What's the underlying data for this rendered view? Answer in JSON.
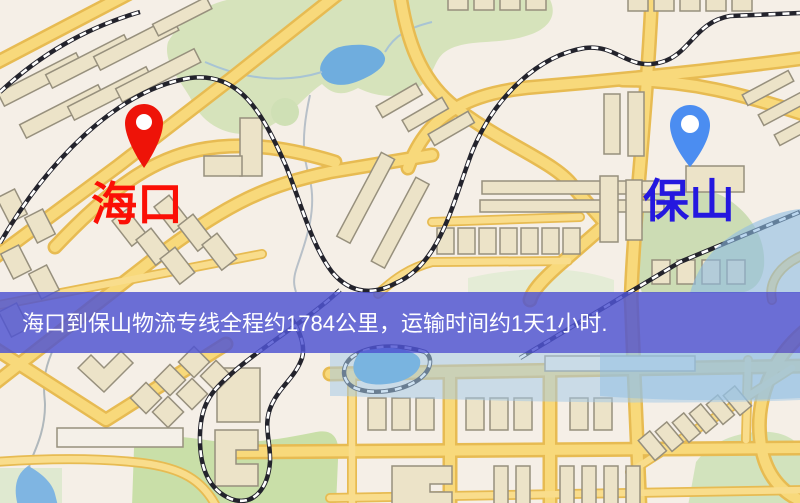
{
  "banner": {
    "text": "海口到保山物流专线全程约1784公里，运输时间约1天1小时.",
    "background": "#5055d2",
    "text_color": "#ffffff"
  },
  "origin": {
    "label": "海口",
    "icon": "map-pin-icon",
    "pin_color": "#ee1308",
    "label_color": "#fb0f05"
  },
  "destination": {
    "label": "保山",
    "icon": "map-pin-icon",
    "pin_color": "#4b8df1",
    "label_color": "#2418df"
  },
  "route": {
    "distance_text": "约1784公里",
    "duration_text": "约1天1小时"
  }
}
